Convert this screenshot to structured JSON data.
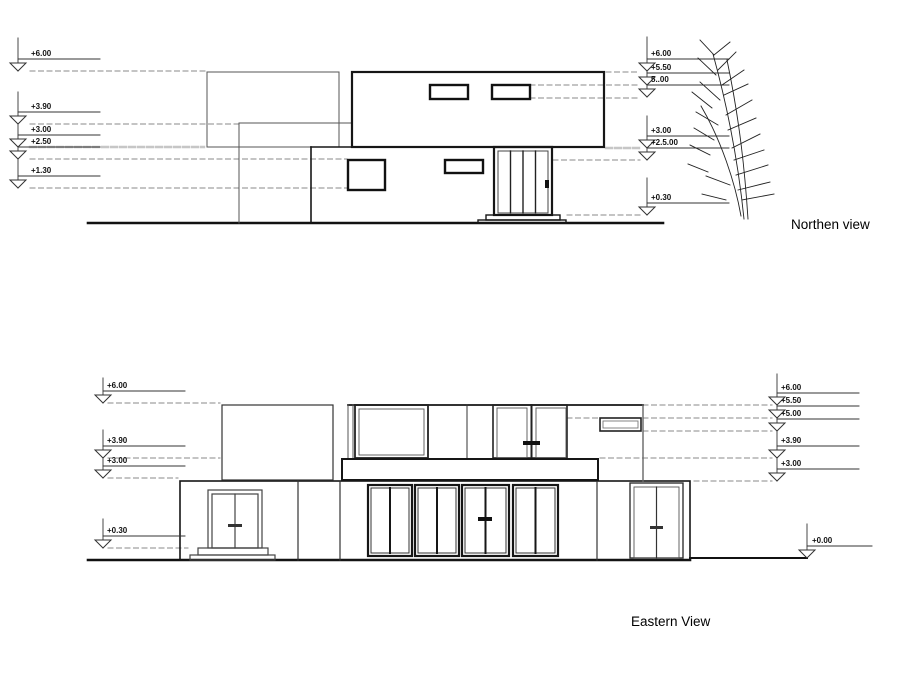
{
  "sheet": {
    "background": "#ffffff"
  },
  "northern_view": {
    "title": "Northen view",
    "left_levels": [
      "+6.00",
      "+3.90",
      "+3.00",
      "+2.50",
      "+1.30"
    ],
    "right_levels": [
      "+6.00",
      "+5.50",
      "5..00",
      "+3.00",
      "+2.5.00",
      "+0.30"
    ]
  },
  "eastern_view": {
    "title": "Eastern View",
    "left_levels": [
      "+6.00",
      "+3.90",
      "+3.00",
      "+0.30"
    ],
    "right_levels": [
      "+6.00",
      "+5.50",
      "+5.00",
      "+3.90",
      "+3.00"
    ],
    "ground_marker": "+0.00"
  }
}
